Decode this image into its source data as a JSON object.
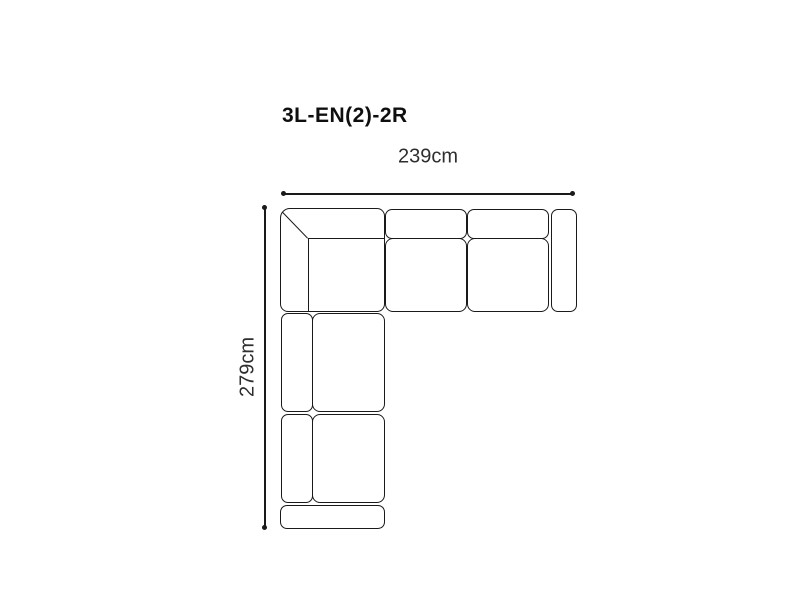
{
  "diagram": {
    "title": "3L-EN(2)-2R",
    "dimensions": {
      "width_label": "239cm",
      "height_label": "279cm"
    },
    "pieces": [
      "corner-section",
      "seat-cushion-1",
      "seat-cushion-2",
      "right-armrest",
      "chaise-cushion-1",
      "chaise-cushion-2",
      "end-section"
    ],
    "colors": {
      "background": "#ffffff",
      "outline": "#1a1a1a",
      "title_text": "#0f0f0f",
      "label_text": "#2e2e2e"
    }
  }
}
